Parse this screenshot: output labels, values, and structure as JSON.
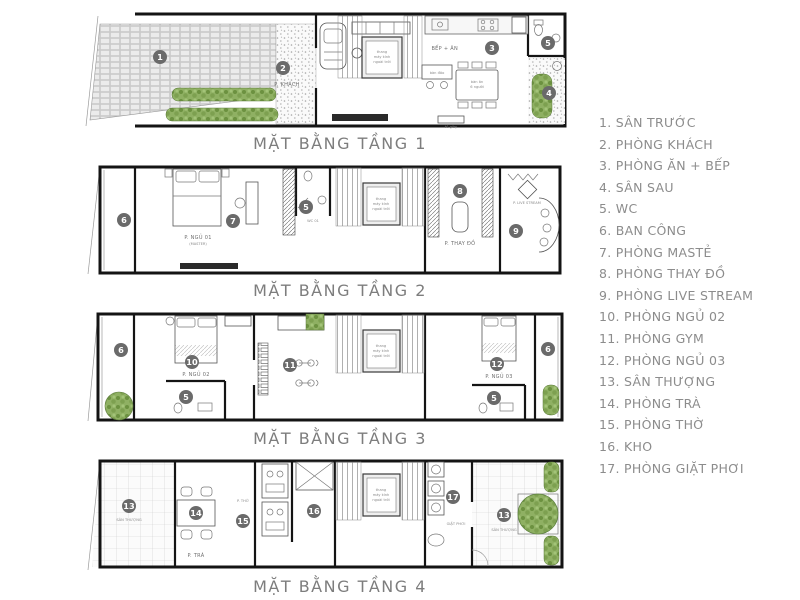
{
  "legend": {
    "items": [
      "1. SÂN TRƯỚC",
      "2. PHÒNG KHÁCH",
      "3. PHÒNG ĂN + BẾP",
      "4. SÂN SAU",
      "5. WC",
      "6. BAN CÔNG",
      "7. PHÒNG MASTẺ",
      "8. PHÒNG THAY ĐỒ",
      "9. PHÒNG LIVE STREAM",
      "10. PHÒNG NGỦ 02",
      "11. PHÒNG GYM",
      "12. PHÒNG NGỦ 03",
      "13. SÂN THƯỢNG",
      "14. PHÒNG TRÀ",
      "15. PHÒNG THỜ",
      "16. KHO",
      "17. PHÒNG GIẶT PHƠI"
    ]
  },
  "floors": [
    {
      "caption": "MẶT BẰNG TẦNG 1",
      "badges": {
        "yard": "1",
        "living": "2",
        "kitchen": "3",
        "backyard": "4",
        "wc": "5"
      },
      "labels": {
        "living": "P. KHÁCH",
        "kitchen": "BẾP + ĂN",
        "island": "bàn đảo",
        "dining1": "bàn ăn",
        "dining2": "6 người",
        "shoe": "tủ giày",
        "elev1": "thang",
        "elev2": "máy kính",
        "elev3": "ngoài trời"
      }
    },
    {
      "caption": "MẶT BẰNG TẦNG 2",
      "badges": {
        "balcony": "6",
        "master": "7",
        "wc": "5",
        "closet": "8",
        "live": "9"
      },
      "labels": {
        "bed1": "P. NGỦ 01",
        "bed2": "(MASTER)",
        "wc": "WC 01",
        "closet": "P. THAY ĐỒ",
        "live": "P. LIVE STREAM",
        "elev1": "thang",
        "elev2": "máy kính",
        "elev3": "ngoài trời"
      }
    },
    {
      "caption": "MẶT BẰNG TẦNG 3",
      "badges": {
        "balcony_l": "6",
        "bed02": "10",
        "wc_l": "5",
        "gym": "11",
        "bed03": "12",
        "wc_r": "5",
        "balcony_r": "6"
      },
      "labels": {
        "bed02": "P. NGỦ 02",
        "bed03": "P. NGỦ 03",
        "elev1": "thang",
        "elev2": "máy kính",
        "elev3": "ngoài trời"
      }
    },
    {
      "caption": "MẶT BẰNG TẦNG 4",
      "badges": {
        "terrace_l": "13",
        "tea": "14",
        "altar": "15",
        "kho": "16",
        "laundry": "17",
        "terrace_r": "13"
      },
      "labels": {
        "terrace_l": "SÂN THƯỢNG",
        "terrace_r": "SÂN THƯỢNG",
        "tea": "P. TRÀ",
        "altar": "P. THỜ",
        "laundry": "GIẶT PHƠI",
        "elev1": "thang",
        "elev2": "máy kính",
        "elev3": "ngoài trời"
      }
    }
  ]
}
